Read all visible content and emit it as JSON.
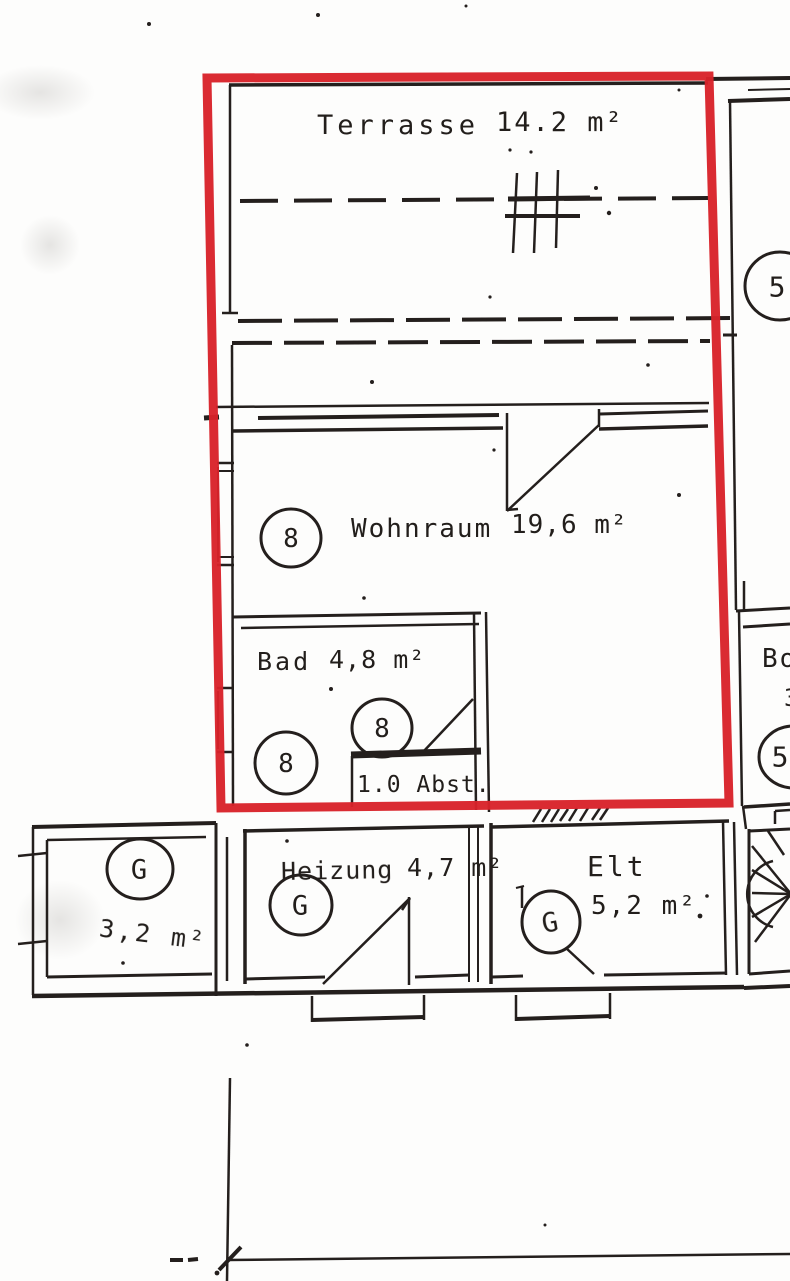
{
  "annotation": {
    "shape": "rectangle-outline",
    "color": "#d8222a"
  },
  "plan": {
    "highlighted_unit": {
      "terrasse": {
        "name": "Terrasse",
        "area": "14.2 m²"
      },
      "wohnraum": {
        "name": "Wohnraum",
        "area": "19,6 m²",
        "badge": "8"
      },
      "bad": {
        "name": "Bad",
        "area": "4,8 m²",
        "badge_left": "8",
        "badge_door": "8"
      },
      "abstellraum": {
        "label": "1.0 Abst."
      }
    },
    "ground_rooms": {
      "storage_left": {
        "area": "3,2 m²",
        "badge": "G"
      },
      "heizung": {
        "name": "Heizung",
        "area": "4,7 m²",
        "badge": "G"
      },
      "elt": {
        "name": "Elt",
        "area": "5,2 m²",
        "badge": "G"
      }
    },
    "neighbor_unit": {
      "badge_top": "5",
      "badge_bottom": "5",
      "room_label_partial": "Bo",
      "area_partial": "3"
    }
  },
  "ink": {
    "line_color": "#241f1d",
    "paper_color": "#fdfdfc"
  }
}
